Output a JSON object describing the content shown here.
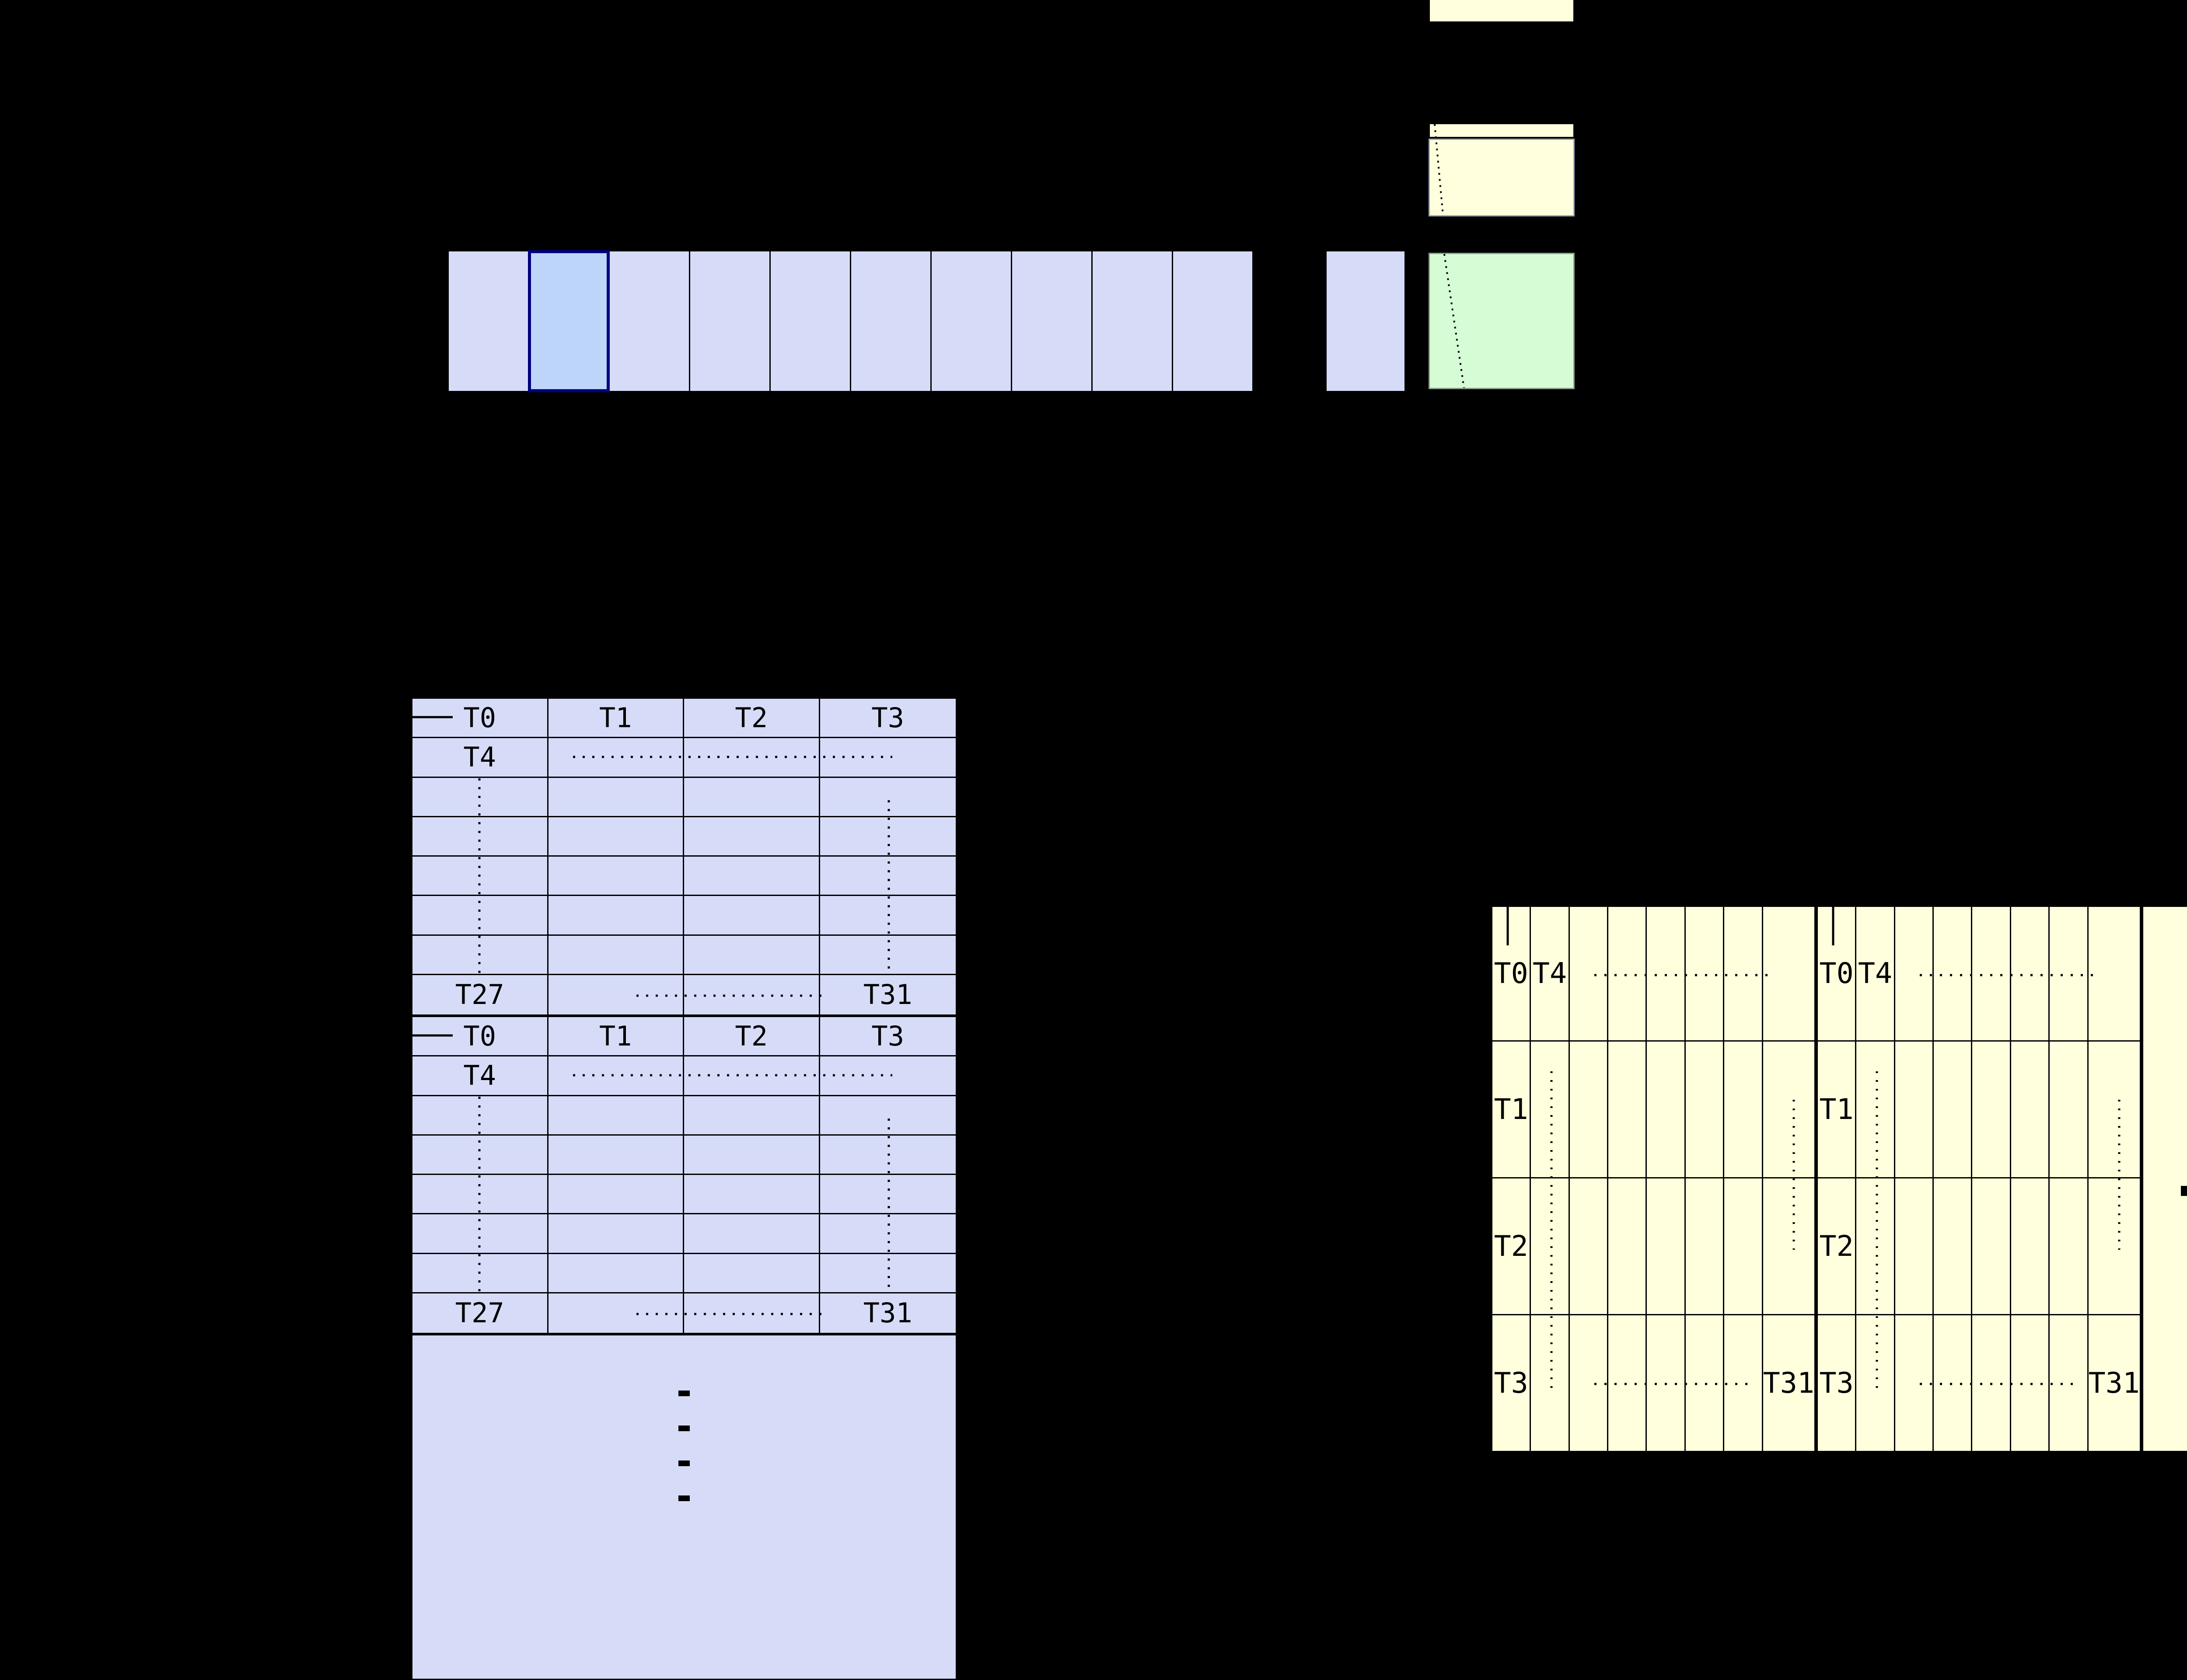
{
  "colors": {
    "background": "#000000",
    "block_fill": "#d6dcf8",
    "block_highlight_fill": "#bed5fa",
    "block_highlight_border": "#00007d",
    "yellow_fill": "#ffffde",
    "yellow_panel_border": "#9aa3c4",
    "green_fill": "#d6fcd6",
    "green_border": "#8a9c8a",
    "grid_line": "#000000"
  },
  "top_row": {
    "cell_count": 10,
    "highlighted_index": 2,
    "separate_cell_count": 1
  },
  "left_table": {
    "columns": 4,
    "rows_per_group": 8,
    "groups": [
      {
        "header_labels": [
          "T0",
          "T1",
          "T2",
          "T3"
        ],
        "row2_label": "T4",
        "bottom_first_label": "T27",
        "bottom_last_label": "T31"
      },
      {
        "header_labels": [
          "T0",
          "T1",
          "T2",
          "T3"
        ],
        "row2_label": "T4",
        "bottom_first_label": "T27",
        "bottom_last_label": "T31"
      }
    ],
    "ellipsis_dash_count": 4
  },
  "right_table": {
    "rows": 4,
    "columns_per_subtable": 8,
    "subtables": [
      {
        "row1_labels": [
          "T0",
          "T4"
        ],
        "row_labels": [
          "T1",
          "T2",
          "T3"
        ],
        "bottom_last_label": "T31"
      },
      {
        "row1_labels": [
          "T0",
          "T4"
        ],
        "row_labels": [
          "T1",
          "T2",
          "T3"
        ],
        "bottom_last_label": "T31"
      }
    ],
    "ellipsis_dot_count": 4
  }
}
